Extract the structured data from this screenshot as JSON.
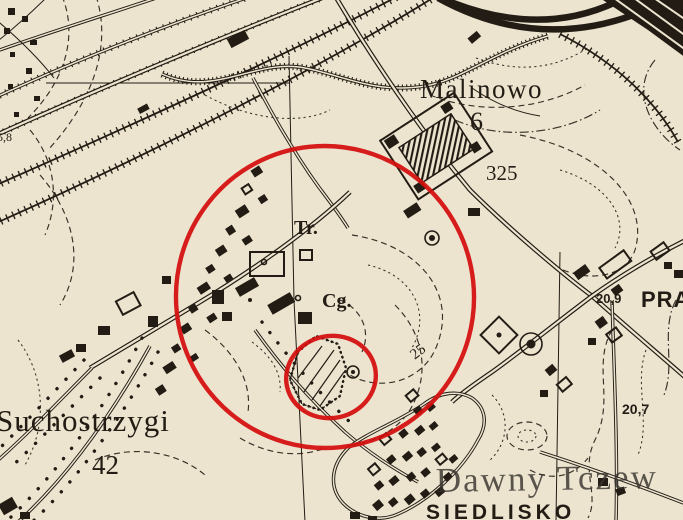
{
  "map": {
    "description_labels": {
      "malinowo": "Malinowo",
      "malinowo_number": "6",
      "road_number_325": "325",
      "tr_abbrev": "Tr.",
      "cg_abbrev": "Cg.",
      "suchostrzygi": "Suchostrzygi",
      "suchostrzygi_number": "42",
      "elevation_20_9": "20,9",
      "pra_partial": "PRA",
      "elevation_20_7": "20,7",
      "contour_label_25": "25",
      "elevation_5_8": "5,8",
      "siedlisko": "SIEDLISKO"
    },
    "watermark": {
      "text": "Dawny Tczew"
    },
    "annotations": {
      "large_red_circle": {
        "shape": "ellipse",
        "color": "#d40e0e"
      },
      "small_red_circle": {
        "shape": "ellipse",
        "color": "#d40e0e"
      }
    },
    "colors": {
      "paper": "#ece4cf",
      "ink": "#221c14",
      "annotation_red": "#d40e0e",
      "watermark_gray": "#35312b"
    }
  }
}
